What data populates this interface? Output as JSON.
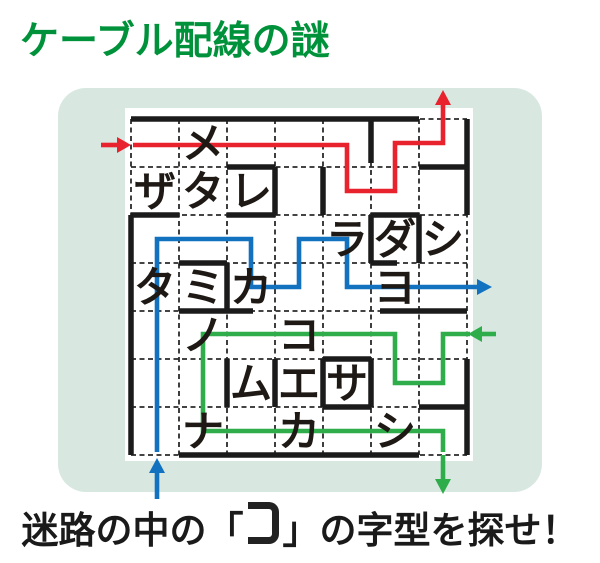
{
  "title": "ケーブル配線の謎",
  "caption": {
    "prefix": "迷路の中の「",
    "target_shape": "コ",
    "suffix": "」の字型を探せ！"
  },
  "colors": {
    "title_green": "#00923b",
    "panel_bg": "#d8e8e1",
    "maze_bg": "#ffffff",
    "wall": "#1b1b1b",
    "grid_line": "#2a2a2a",
    "letter_text": "#1e1915",
    "cable_red": "#e8232d",
    "cable_blue": "#1272c0",
    "cable_green": "#2fad4a"
  },
  "maze": {
    "grid": {
      "cols": 7,
      "rows": 7
    },
    "letters": [
      {
        "char": "メ",
        "col": 1,
        "row": 0
      },
      {
        "char": "ザ",
        "col": 0,
        "row": 1
      },
      {
        "char": "タ",
        "col": 1,
        "row": 1
      },
      {
        "char": "レ",
        "col": 2,
        "row": 1
      },
      {
        "char": "ラ",
        "col": 4,
        "row": 2
      },
      {
        "char": "ダ",
        "col": 5,
        "row": 2
      },
      {
        "char": "シ",
        "col": 6,
        "row": 2
      },
      {
        "char": "タ",
        "col": 0,
        "row": 3
      },
      {
        "char": "ミ",
        "col": 1,
        "row": 3
      },
      {
        "char": "カ",
        "col": 2,
        "row": 3
      },
      {
        "char": "ヨ",
        "col": 5,
        "row": 3
      },
      {
        "char": "ノ",
        "col": 1,
        "row": 4
      },
      {
        "char": "コ",
        "col": 3,
        "row": 4
      },
      {
        "char": "ム",
        "col": 2,
        "row": 5
      },
      {
        "char": "エ",
        "col": 3,
        "row": 5
      },
      {
        "char": "サ",
        "col": 4,
        "row": 5
      },
      {
        "char": "ナ",
        "col": 1,
        "row": 6
      },
      {
        "char": "カ",
        "col": 3,
        "row": 6
      },
      {
        "char": "シ",
        "col": 5,
        "row": 6
      }
    ],
    "cables": [
      {
        "name": "red",
        "color": "#e8232d",
        "entry": "left edge, row 0, arrow pointing right",
        "exit": "top edge, column 6, arrow pointing up"
      },
      {
        "name": "blue",
        "color": "#1272c0",
        "entry": "bottom edge, column 0, arrow pointing up",
        "exit": "right edge, row 3, arrow pointing right"
      },
      {
        "name": "green",
        "color": "#2fad4a",
        "entry": "right edge, row 4, arrow pointing left",
        "exit": "bottom edge, column 6, arrow pointing down"
      }
    ]
  }
}
